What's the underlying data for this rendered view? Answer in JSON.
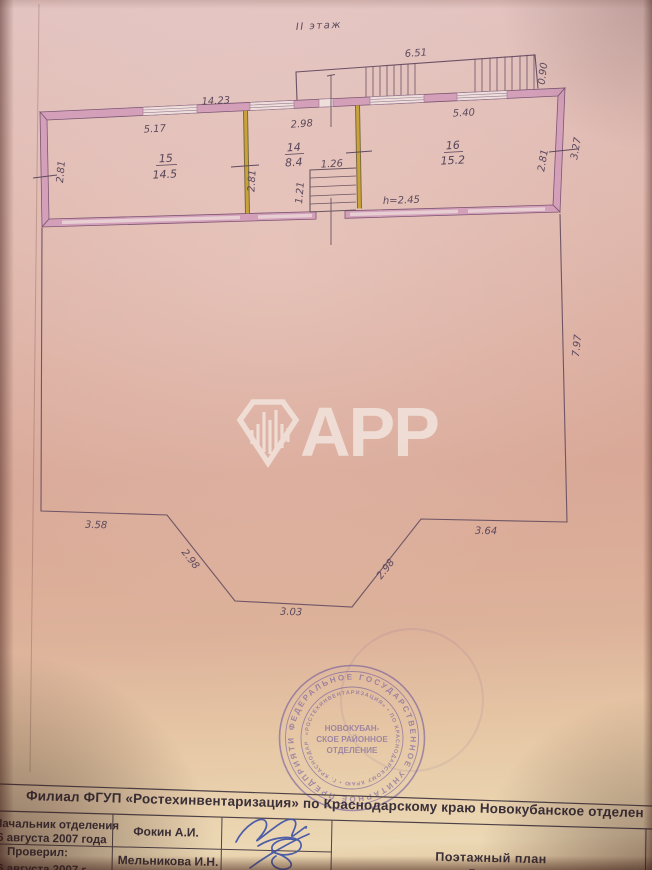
{
  "page": {
    "title": "II этаж"
  },
  "watermark": {
    "text": "APP"
  },
  "plan": {
    "rooms": [
      {
        "number": "15",
        "area": "14.5"
      },
      {
        "number": "14",
        "area": "8.4"
      },
      {
        "number": "16",
        "area": "15.2"
      }
    ],
    "height_note": "h=2.45",
    "dimensions": {
      "stair_top": "6.51",
      "stair_depth": "0.90",
      "overall_left": "14.23",
      "window_room15": "5.17",
      "window_room14": "2.98",
      "window_room16": "5.40",
      "wall_left": "2.81",
      "wall_mid": "2.81",
      "wall_right_inner": "2.81",
      "wall_right_outer": "3.27",
      "stairs_width": "1.26",
      "stairs_depth": "1.21",
      "terrace_right": "7.97",
      "terrace_bottom_left": "3.58",
      "terrace_chamfer_left": "2.98",
      "terrace_bottom": "3.03",
      "terrace_chamfer_right": "2.98",
      "terrace_bottom_right": "3.64"
    }
  },
  "stamp": {
    "outer_ring": "ФЕДЕРАЛЬНОЕ  ГОСУДАРСТВЕННОЕ  УНИТАРНОЕ  ПРЕДПРИЯТИЕ",
    "inner_ring": "«РОСТЕХИНВЕНТАРИЗАЦИЯ» • ПО КРАСНОДАРСКОМУ КРАЮ • Г. КРАСНОДАР",
    "center_line1": "НОВОКУБАН-",
    "center_line2": "СКОЕ РАЙОННОЕ",
    "center_line3": "ОТДЕЛЕНИЕ"
  },
  "footer": {
    "org_line": "Филиал  ФГУП  «Ростехинвентаризация»  по Краснодарскому краю  Новокубанское отделен",
    "table": {
      "approver_role": "Начальник отделения",
      "approver_date": "6 августа  2007 года",
      "approver_name": "Фокин А.И.",
      "checker_role": "Проверил:",
      "checker_date": "6 августа  2007 г",
      "checker_name": "Мельникова И.Н.",
      "doc_title": "Поэтажный план",
      "doc_subtitle": "Литер А"
    }
  }
}
